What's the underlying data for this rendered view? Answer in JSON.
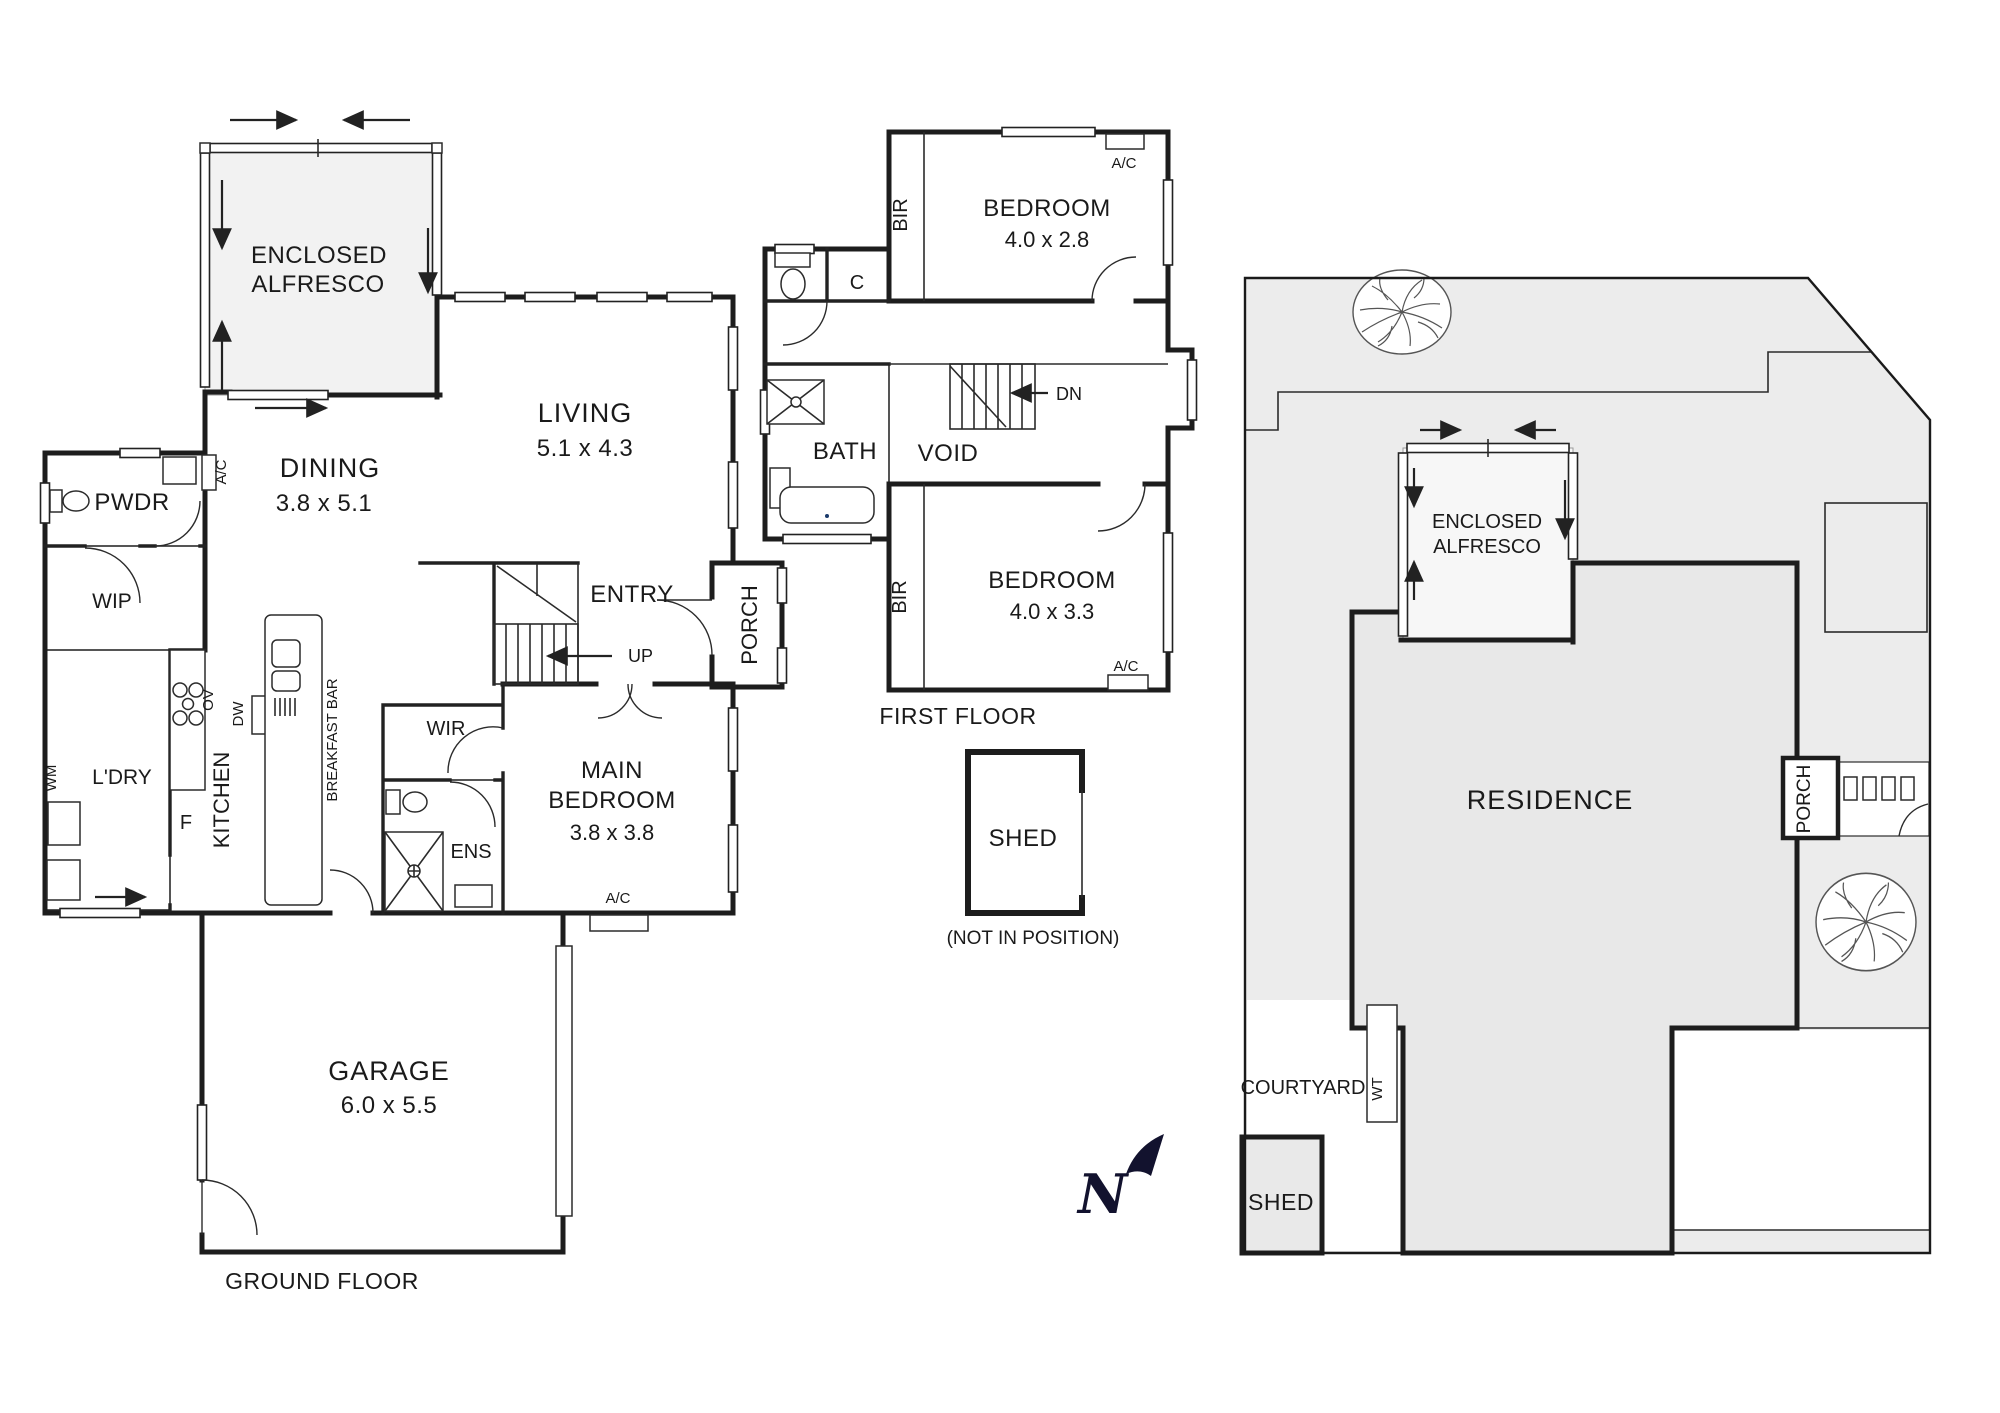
{
  "ground_floor": {
    "label": "GROUND FLOOR",
    "alfresco_line1": "ENCLOSED",
    "alfresco_line2": "ALFRESCO",
    "living": "LIVING",
    "living_dims": "5.1 x 4.3",
    "dining": "DINING",
    "dining_dims": "3.8 x 5.1",
    "pwdr": "PWDR",
    "wip": "WIP",
    "ldry": "L'DRY",
    "wm": "WM",
    "fridge": "F",
    "kitchen": "KITCHEN",
    "ov": "OV",
    "dw": "DW",
    "breakfast_bar": "BREAKFAST BAR",
    "entry": "ENTRY",
    "up": "UP",
    "porch": "PORCH",
    "wir": "WIR",
    "ens": "ENS",
    "main_bed_line1": "MAIN",
    "main_bed_line2": "BEDROOM",
    "main_bed_dims": "3.8 x 3.8",
    "garage": "GARAGE",
    "garage_dims": "6.0 x 5.5"
  },
  "first_floor": {
    "label": "FIRST FLOOR",
    "bedroom": "BEDROOM",
    "bed1_dims": "4.0 x 2.8",
    "bed2_dims": "4.0 x 3.3",
    "bir": "BIR",
    "c": "C",
    "bath": "BATH",
    "void": "VOID",
    "dn": "DN"
  },
  "shared": {
    "ac": "A/C"
  },
  "shed": {
    "label": "SHED",
    "note": "(NOT IN POSITION)"
  },
  "site": {
    "residence": "RESIDENCE",
    "porch": "PORCH",
    "courtyard": "COURTYARD",
    "wt": "WT",
    "shed": "SHED",
    "alfresco_line1": "ENCLOSED",
    "alfresco_line2": "ALFRESCO"
  },
  "compass": {
    "n": "N"
  },
  "colors": {
    "wall": "#1d1d1d",
    "lot_fill": "#ececec",
    "residence_fill": "#e8e8e8",
    "alfresco_fill": "#f2f2f2",
    "north": "#12122e"
  }
}
